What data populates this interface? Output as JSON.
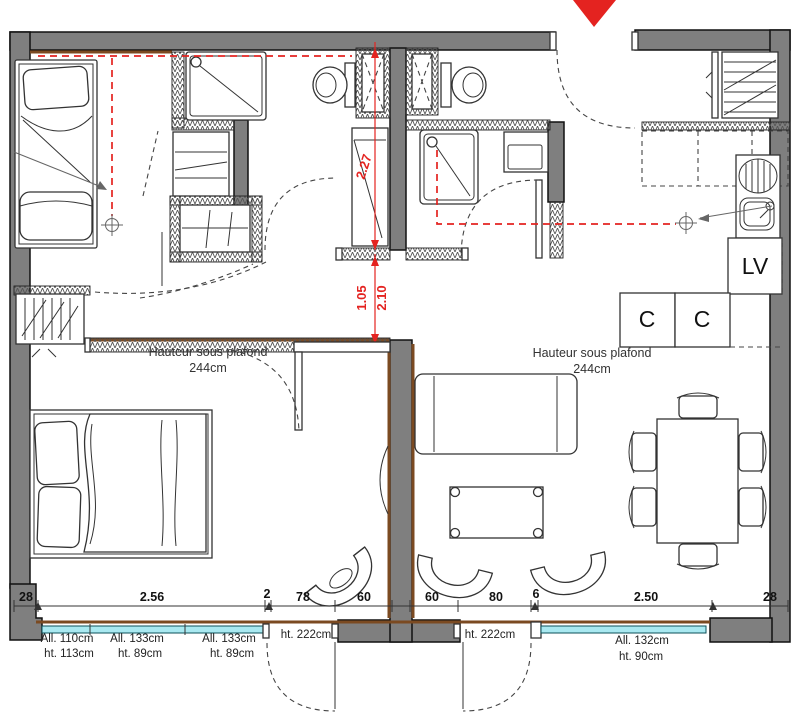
{
  "plan": {
    "type": "apartment-floor-plan",
    "red_dimensions": {
      "bathroom_height": "2.27",
      "opening_width": "1.05",
      "opening_height": "2.10"
    },
    "ceiling": {
      "left": {
        "title": "Hauteur sous plafond",
        "value": "244cm"
      },
      "right": {
        "title": "Hauteur sous plafond",
        "value": "244cm"
      }
    },
    "kitchen": {
      "dishwasher": "LV",
      "cabinet_1": "C",
      "cabinet_2": "C"
    },
    "bottom_dims": [
      "28",
      "2.56",
      "2",
      "78",
      "60",
      "60",
      "80",
      "6",
      "2.50",
      "28"
    ],
    "openings": {
      "window_1a": {
        "l1": "All. 110cm",
        "l2": "ht. 113cm"
      },
      "window_1b": {
        "l1": "All. 133cm",
        "l2": "ht. 89cm"
      },
      "window_1c": {
        "l1": "All. 133cm",
        "l2": "ht. 89cm"
      },
      "door_left": {
        "l1": "ht. 222cm"
      },
      "door_right": {
        "l1": "ht. 222cm"
      },
      "window_2": {
        "l1": "All. 132cm",
        "l2": "ht. 90cm"
      }
    },
    "colors": {
      "wall_gray": "#7f7f7f",
      "wood_brown": "#7b4a21",
      "glazing_cyan": "#a9e9f1",
      "dimension_red": "#e42320",
      "entrance_arrow": "#e42320",
      "line_dark": "#333333"
    }
  }
}
